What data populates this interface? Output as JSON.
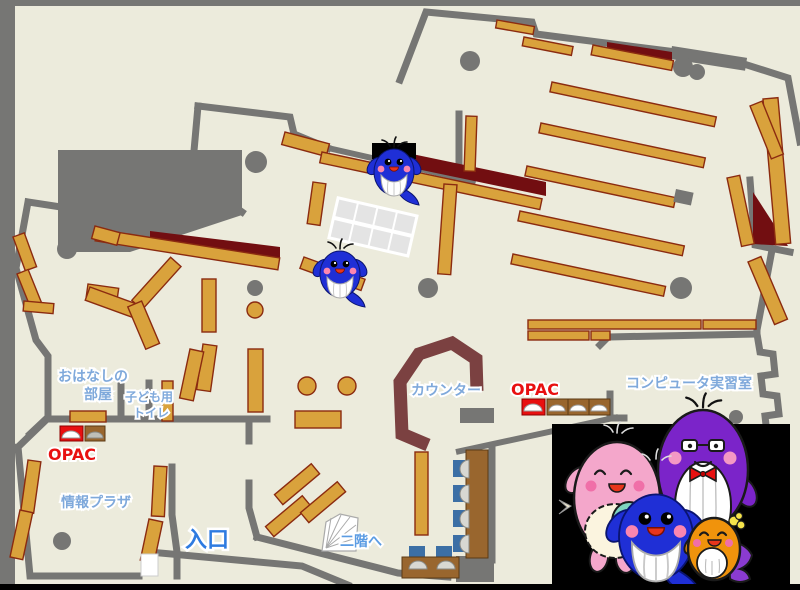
{
  "map": {
    "title": "library-first-floor-map",
    "labels": {
      "storytime_line1": "おはなしの",
      "storytime_line2": "部屋",
      "kids_toilet_line1": "子ども用",
      "kids_toilet_line2": "トイレ",
      "opac_left": "OPAC",
      "info_plaza": "情報プラザ",
      "entrance": "入口",
      "counter": "カウンター",
      "opac_center": "OPAC",
      "computer_room": "コンピュータ実習室",
      "stairs_up": "二階へ"
    },
    "colors": {
      "floor": "#ECEBDC",
      "wall_gray": "#767674",
      "shelf_orange": "#D9A23C",
      "shelf_border": "#8B2B10",
      "dark_red_area": "#720E11",
      "counter_brown": "#7B4141",
      "opac_red": "#E81010",
      "label_blue": "#7FA9DB",
      "entrance_blue": "#2E7BE0",
      "stairs_blue": "#5B9CE3",
      "desk_brown": "#99662E",
      "chair_blue": "#3C6FA5",
      "panel_black": "#000000",
      "mascot_blue": "#1F2FD6",
      "mascot_pink": "#F4A7CB",
      "mascot_purple": "#7B24C9",
      "mascot_orange": "#F0930C",
      "mascot_teal": "#7FD4C0"
    },
    "icons": {
      "map_whale_count": 2,
      "panel_mascots": "pink-whale, purple-whale, blue-whale, orange-whale"
    }
  }
}
